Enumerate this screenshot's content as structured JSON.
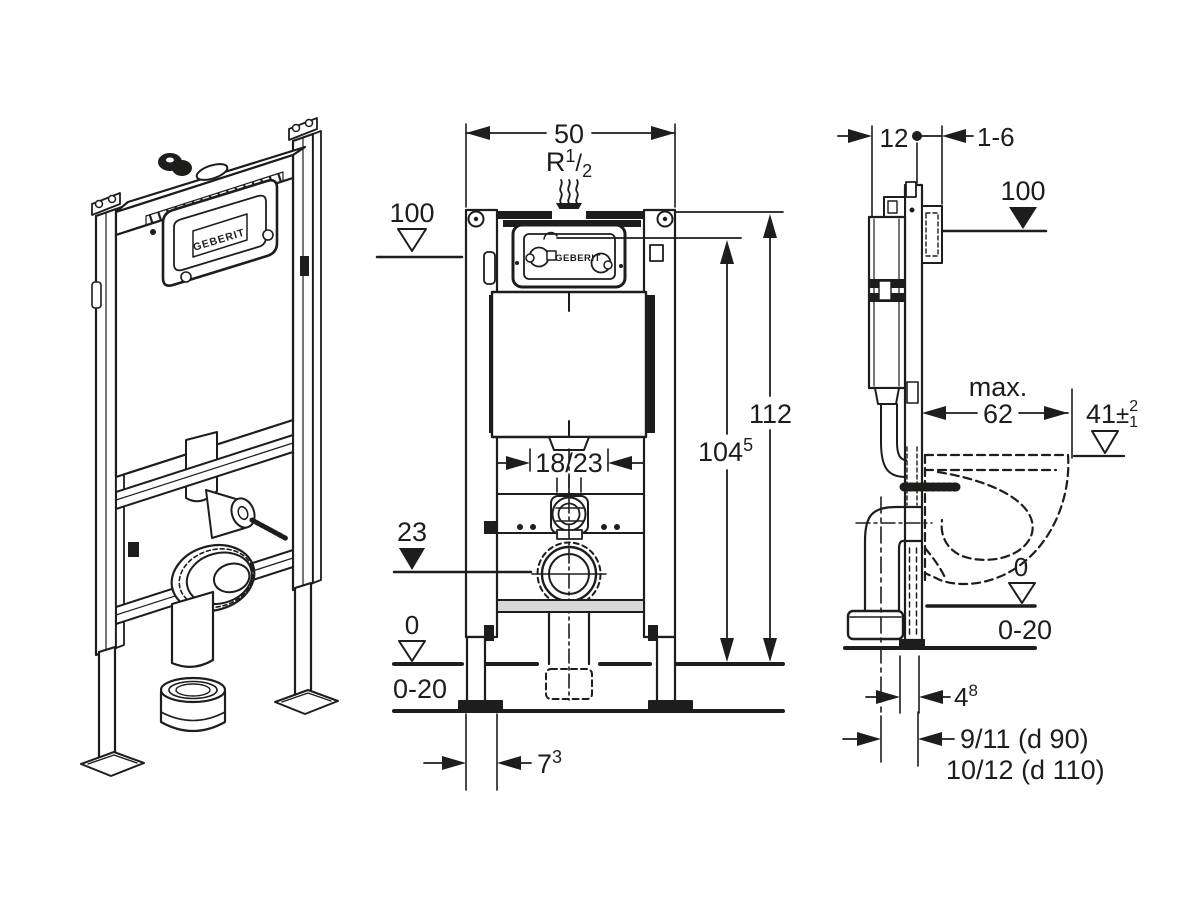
{
  "colors": {
    "line": "#1d1d1b",
    "background": "#ffffff",
    "plate_fill": "#d8d8d8"
  },
  "logo": "GEBERIT",
  "front_view": {
    "width": "50",
    "supply_r": "R",
    "supply_sup": "1",
    "supply_slash": "/",
    "supply_sub": "2",
    "plate_height": "100",
    "total_height": "112",
    "actuator_height": "104",
    "actuator_height_sup": "5",
    "supply_offset": "18/23",
    "outlet_height": "23",
    "zero": "0",
    "floor_range": "0-20",
    "foot_depth": "7",
    "foot_depth_sup": "3"
  },
  "side_view": {
    "frame_depth": "12",
    "wall_thickness": "1-6",
    "plate_height": "100",
    "max_label": "max.",
    "bowl_depth": "62",
    "bowl_height": "41",
    "bowl_height_pm": "±",
    "bowl_height_plus": "2",
    "bowl_height_minus": "1",
    "zero": "0",
    "floor_range": "0-20",
    "outlet_offset": "4",
    "outlet_offset_sup": "8",
    "outlet_d90": "9/11 (d 90)",
    "outlet_d110": "10/12 (d 110)"
  }
}
